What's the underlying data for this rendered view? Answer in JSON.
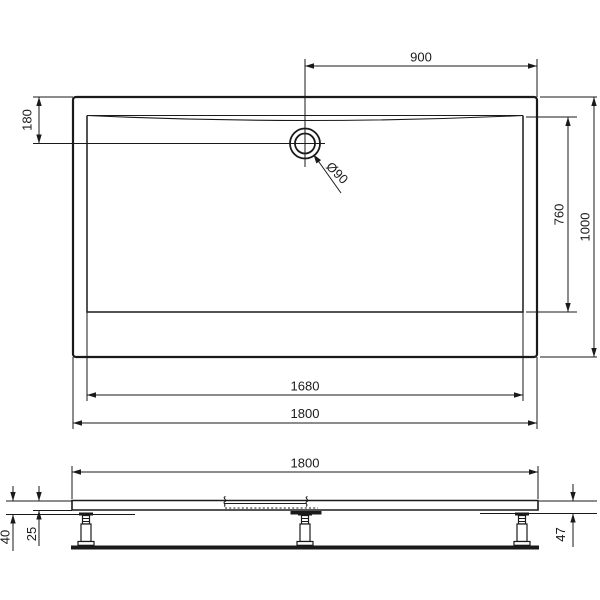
{
  "drawing_type": "shower-tray-technical-drawing",
  "colors": {
    "line": "#1a1a1a",
    "background": "#ffffff"
  },
  "top_view": {
    "dim_drain_to_right_edge": "900",
    "dim_drain_to_top_edge": "180",
    "drain_diameter_label": "Ø90",
    "dim_inner_width": "760",
    "dim_outer_width": "1000",
    "dim_inner_length": "1680",
    "dim_outer_length": "1800"
  },
  "side_view": {
    "dim_overall_length": "1800",
    "dim_left_height_overall": "40",
    "dim_left_height_tray": "25",
    "dim_right_height": "47"
  }
}
